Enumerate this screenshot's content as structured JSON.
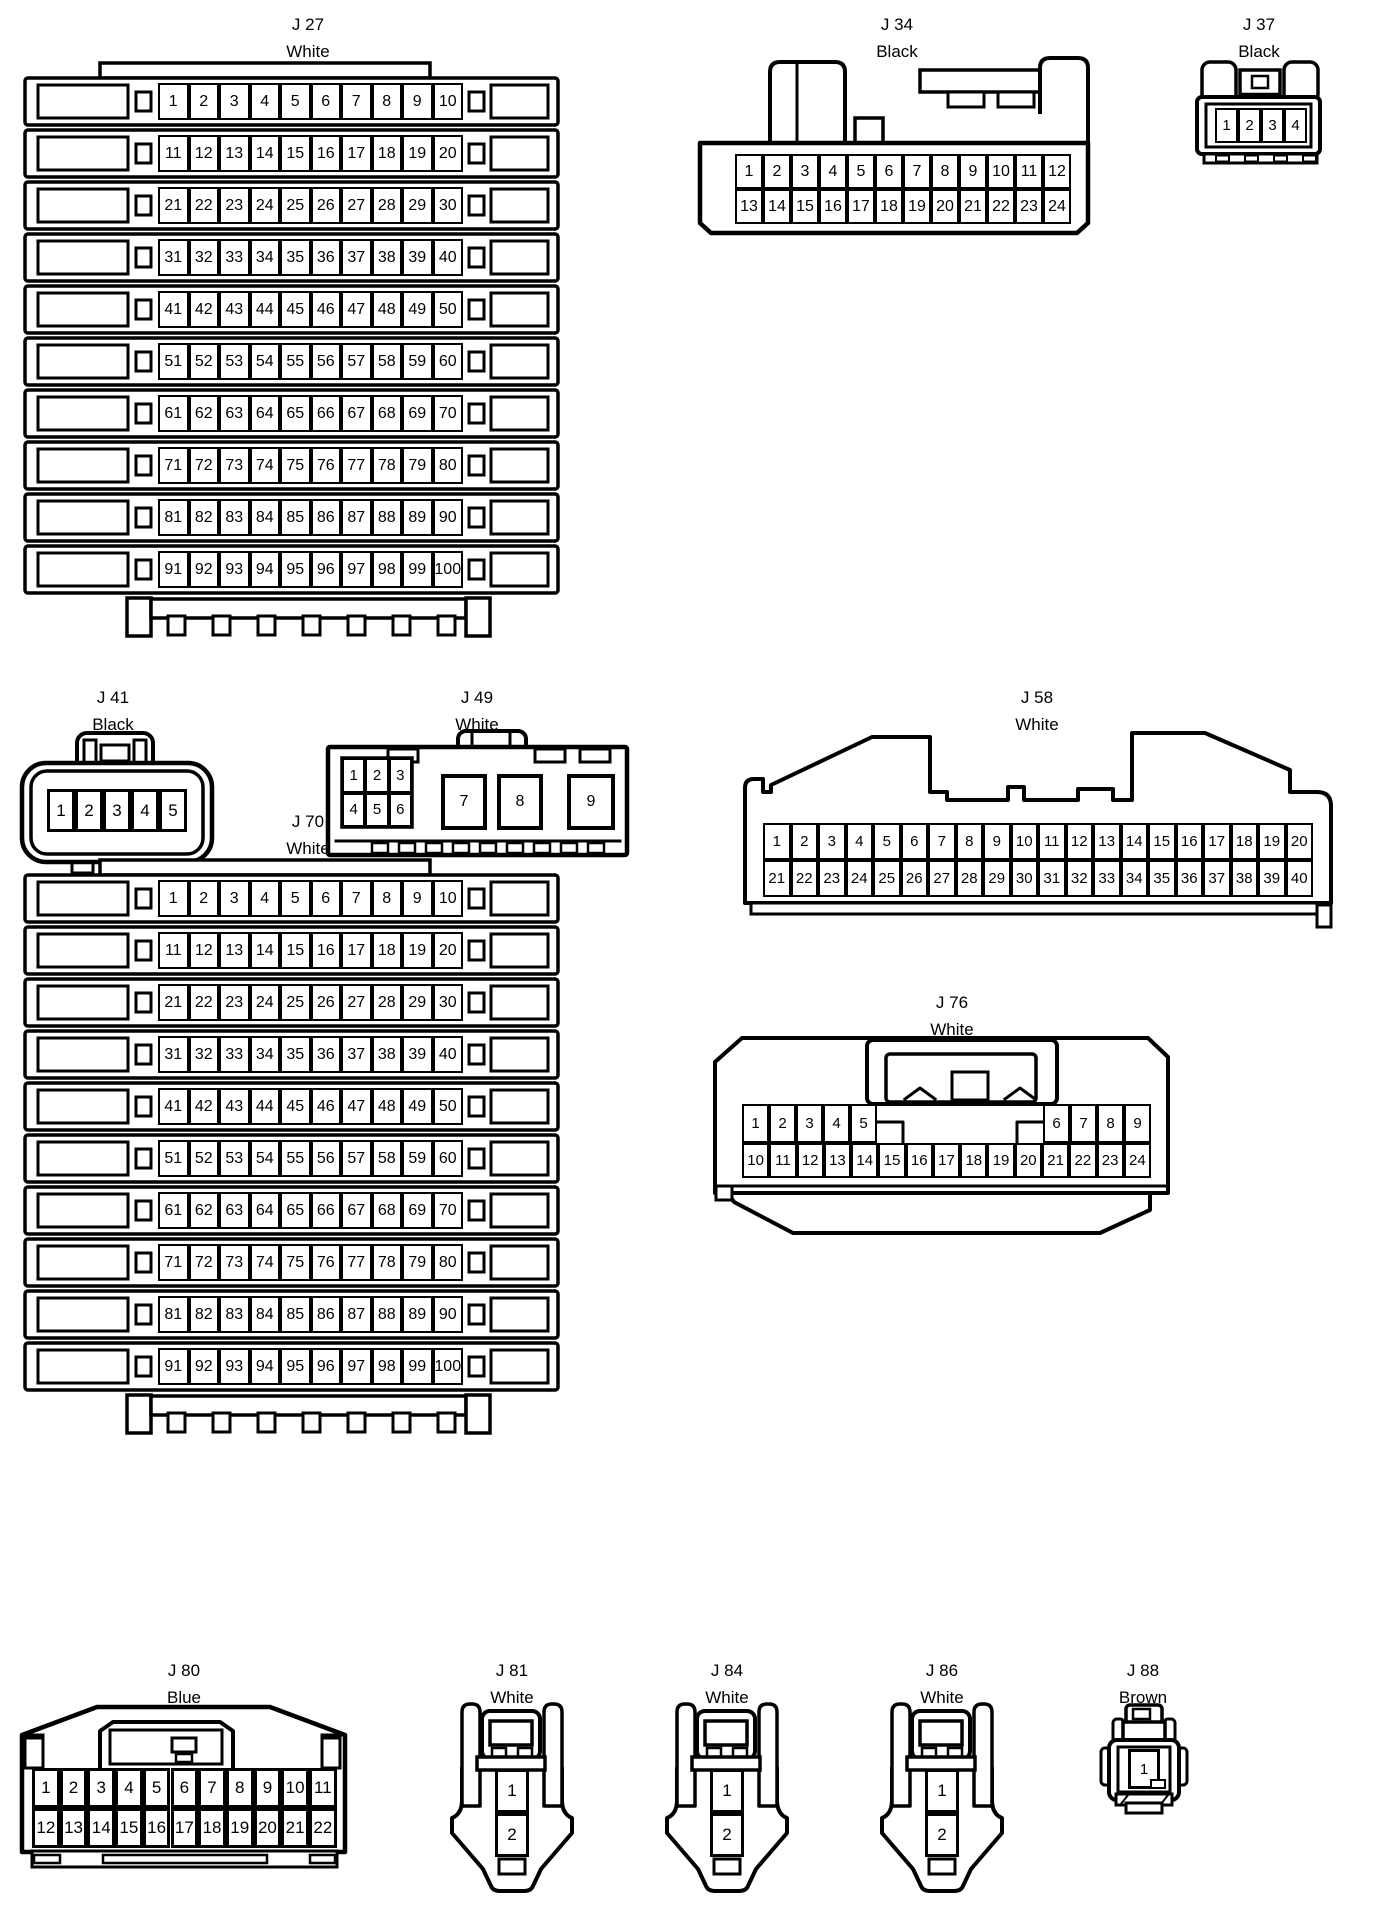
{
  "page": {
    "background": "#ffffff",
    "line_color": "#000000"
  },
  "connectors": [
    {
      "id": "j27",
      "name": "J 27",
      "color_name": "White",
      "pin_rows": [
        [
          1,
          2,
          3,
          4,
          5,
          6,
          7,
          8,
          9,
          10
        ],
        [
          11,
          12,
          13,
          14,
          15,
          16,
          17,
          18,
          19,
          20
        ],
        [
          21,
          22,
          23,
          24,
          25,
          26,
          27,
          28,
          29,
          30
        ],
        [
          31,
          32,
          33,
          34,
          35,
          36,
          37,
          38,
          39,
          40
        ],
        [
          41,
          42,
          43,
          44,
          45,
          46,
          47,
          48,
          49,
          50
        ],
        [
          51,
          52,
          53,
          54,
          55,
          56,
          57,
          58,
          59,
          60
        ],
        [
          61,
          62,
          63,
          64,
          65,
          66,
          67,
          68,
          69,
          70
        ],
        [
          71,
          72,
          73,
          74,
          75,
          76,
          77,
          78,
          79,
          80
        ],
        [
          81,
          82,
          83,
          84,
          85,
          86,
          87,
          88,
          89,
          90
        ],
        [
          91,
          92,
          93,
          94,
          95,
          96,
          97,
          98,
          99,
          100
        ]
      ]
    },
    {
      "id": "j34",
      "name": "J 34",
      "color_name": "Black",
      "pin_rows": [
        [
          1,
          2,
          3,
          4,
          5,
          6,
          7,
          8,
          9,
          10,
          11,
          12
        ],
        [
          13,
          14,
          15,
          16,
          17,
          18,
          19,
          20,
          21,
          22,
          23,
          24
        ]
      ]
    },
    {
      "id": "j37",
      "name": "J 37",
      "color_name": "Black",
      "pin_rows": [
        [
          1,
          2,
          3,
          4
        ]
      ]
    },
    {
      "id": "j41",
      "name": "J 41",
      "color_name": "Black",
      "pin_rows": [
        [
          1,
          2,
          3,
          4,
          5
        ]
      ]
    },
    {
      "id": "j49",
      "name": "J 49",
      "color_name": "White",
      "pin_rows": [
        [
          1,
          2,
          3
        ],
        [
          4,
          5,
          6
        ],
        [
          7,
          8,
          9
        ]
      ]
    },
    {
      "id": "j58",
      "name": "J 58",
      "color_name": "White",
      "pin_rows": [
        [
          1,
          2,
          3,
          4,
          5,
          6,
          7,
          8,
          9,
          10,
          11,
          12,
          13,
          14,
          15,
          16,
          17,
          18,
          19,
          20
        ],
        [
          21,
          22,
          23,
          24,
          25,
          26,
          27,
          28,
          29,
          30,
          31,
          32,
          33,
          34,
          35,
          36,
          37,
          38,
          39,
          40
        ]
      ]
    },
    {
      "id": "j70",
      "name": "J 70",
      "color_name": "White",
      "pin_rows": [
        [
          1,
          2,
          3,
          4,
          5,
          6,
          7,
          8,
          9,
          10
        ],
        [
          11,
          12,
          13,
          14,
          15,
          16,
          17,
          18,
          19,
          20
        ],
        [
          21,
          22,
          23,
          24,
          25,
          26,
          27,
          28,
          29,
          30
        ],
        [
          31,
          32,
          33,
          34,
          35,
          36,
          37,
          38,
          39,
          40
        ],
        [
          41,
          42,
          43,
          44,
          45,
          46,
          47,
          48,
          49,
          50
        ],
        [
          51,
          52,
          53,
          54,
          55,
          56,
          57,
          58,
          59,
          60
        ],
        [
          61,
          62,
          63,
          64,
          65,
          66,
          67,
          68,
          69,
          70
        ],
        [
          71,
          72,
          73,
          74,
          75,
          76,
          77,
          78,
          79,
          80
        ],
        [
          81,
          82,
          83,
          84,
          85,
          86,
          87,
          88,
          89,
          90
        ],
        [
          91,
          92,
          93,
          94,
          95,
          96,
          97,
          98,
          99,
          100
        ]
      ]
    },
    {
      "id": "j76",
      "name": "J 76",
      "color_name": "White",
      "pin_rows": [
        [
          1,
          2,
          3,
          4,
          5
        ],
        [
          6,
          7,
          8,
          9
        ],
        [
          10,
          11,
          12,
          13,
          14,
          15,
          16,
          17,
          18,
          19,
          20,
          21,
          22,
          23,
          24
        ]
      ]
    },
    {
      "id": "j80",
      "name": "J 80",
      "color_name": "Blue",
      "pin_rows": [
        [
          1,
          2,
          3,
          4,
          5,
          6,
          7,
          8,
          9,
          10,
          11
        ],
        [
          12,
          13,
          14,
          15,
          16,
          17,
          18,
          19,
          20,
          21,
          22
        ]
      ]
    },
    {
      "id": "j81",
      "name": "J 81",
      "color_name": "White",
      "pin_rows": [
        [
          1
        ],
        [
          2
        ]
      ]
    },
    {
      "id": "j84",
      "name": "J 84",
      "color_name": "White",
      "pin_rows": [
        [
          1
        ],
        [
          2
        ]
      ]
    },
    {
      "id": "j86",
      "name": "J 86",
      "color_name": "White",
      "pin_rows": [
        [
          1
        ],
        [
          2
        ]
      ]
    },
    {
      "id": "j88",
      "name": "J 88",
      "color_name": "Brown",
      "pin_rows": [
        [
          1
        ]
      ]
    }
  ]
}
